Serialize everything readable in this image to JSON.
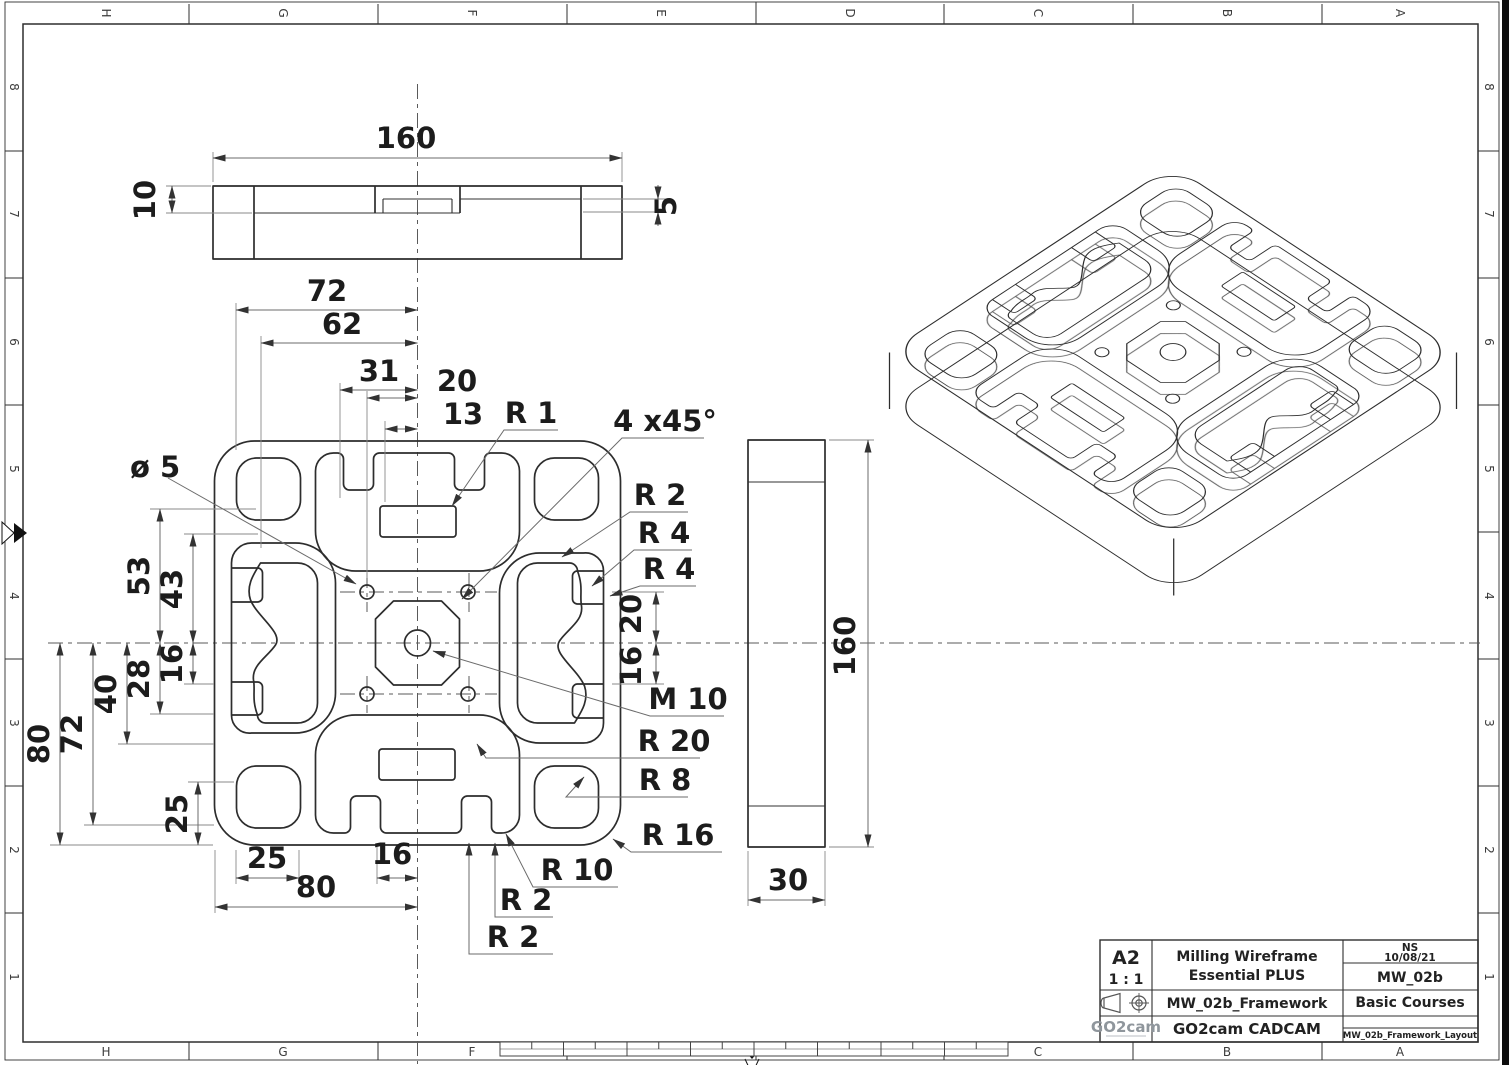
{
  "sheet": {
    "cols": [
      "H",
      "G",
      "F",
      "E",
      "D",
      "C",
      "B",
      "A"
    ],
    "rows": [
      "8",
      "7",
      "6",
      "5",
      "4",
      "3",
      "2",
      "1"
    ]
  },
  "front_view": {
    "width": "160",
    "step": "10",
    "slot": "5"
  },
  "plan_view": {
    "top_dims": [
      "72",
      "62",
      "31",
      "20",
      "13"
    ],
    "left_dims": {
      "d80": "80",
      "d72": "72",
      "d40": "40",
      "d28": "28",
      "d16": "16",
      "d53": "53",
      "d43": "43",
      "d25": "25"
    },
    "bottom_dims": {
      "d25": "25",
      "d80": "80",
      "d16": "16"
    },
    "right_dims": {
      "d20": "20",
      "d16": "16"
    },
    "callouts": {
      "dia5": "ø 5",
      "r1": "R 1",
      "chamfer": "4 x45°",
      "r2_top": "R 2",
      "r4_a": "R 4",
      "r4_b": "R 4",
      "m10": "M 10",
      "r20": "R 20",
      "r8": "R 8",
      "r16": "R 16",
      "r10": "R 10",
      "r2_a": "R 2",
      "r2_b": "R 2"
    }
  },
  "side_view": {
    "height": "160",
    "width": "30"
  },
  "title_block": {
    "format": "A2",
    "scale": "1 : 1",
    "line1": "Milling Wireframe",
    "line2": "Essential PLUS",
    "author": "NS",
    "date": "10/08/21",
    "part_ref": "MW_02b",
    "file_name": "MW_02b_Framework",
    "course": "Basic Courses",
    "brand": "GO2cam",
    "product": "GO2cam CADCAM",
    "layout": "MW_02b_Framework_Layout"
  }
}
